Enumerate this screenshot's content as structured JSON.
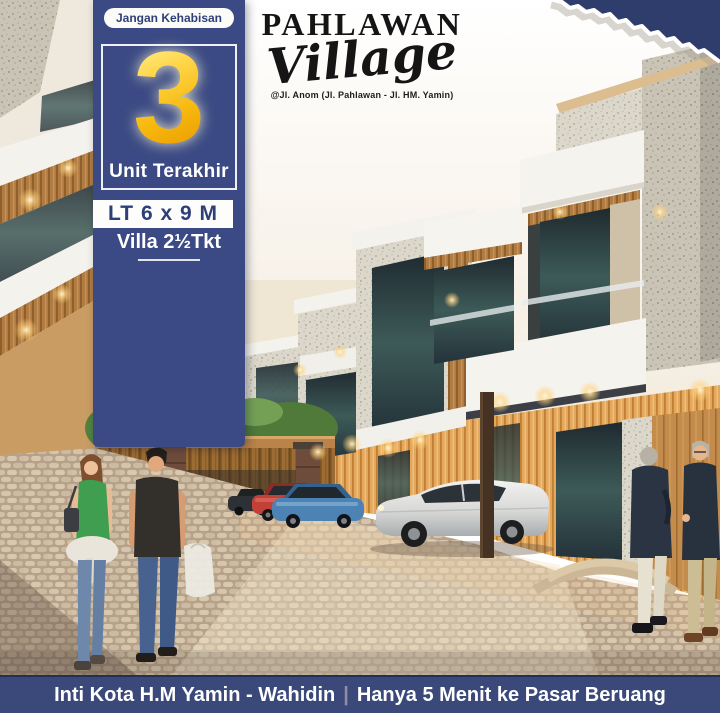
{
  "promo_panel": {
    "badge_label": "Jangan Kehabisan",
    "units_number": "3",
    "units_caption": "Unit Terakhir",
    "land_size": "LT 6 x 9 M",
    "villa_spec": "Villa 2½Tkt"
  },
  "brand": {
    "title": "PAHLAWAN",
    "script": "Village",
    "address": "@Jl. Anom (Jl. Pahlawan - Jl. HM. Yamin)"
  },
  "footer": {
    "location_text": "Inti Kota H.M Yamin - Wahidin",
    "separator": "|",
    "benefit_text": "Hanya 5 Menit ke Pasar Beruang"
  },
  "colors": {
    "panel_navy": "#3b4a84",
    "footer_navy": "#3a4979",
    "torn_corner_navy": "#2f3d6d",
    "gold_number": "#f6b70b",
    "separator_accent": "#948aa2"
  }
}
